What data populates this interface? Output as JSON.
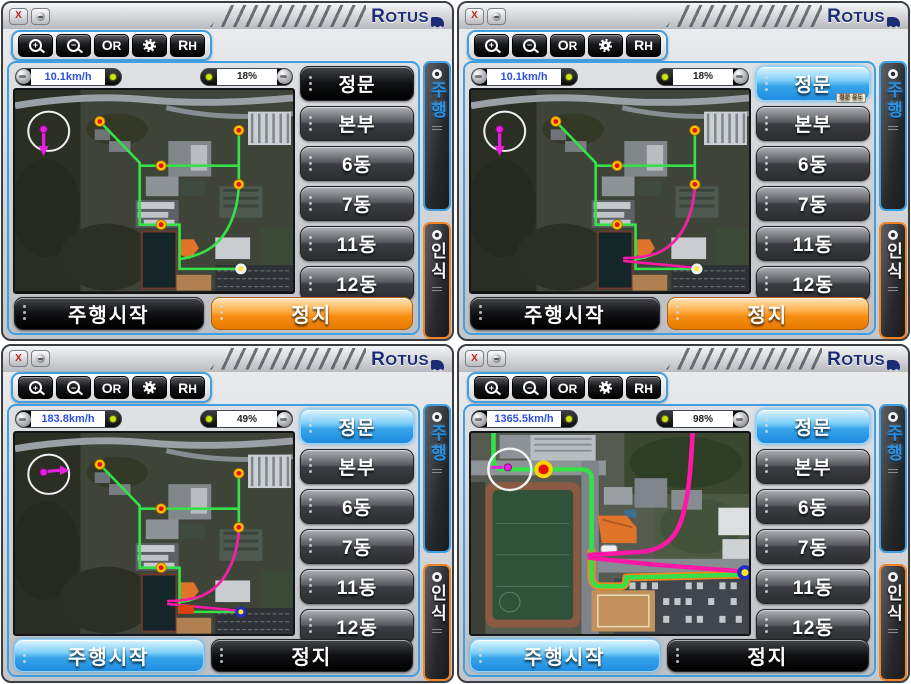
{
  "shared": {
    "logo_text": "ROTUS",
    "window": {
      "close_label": "X"
    },
    "toolbar": {
      "zoom_in": "zoom-in",
      "zoom_out": "zoom-out",
      "or_label": "OR",
      "gear": "settings",
      "rh_label": "RH"
    },
    "destinations": [
      "정문",
      "본부",
      "6동",
      "7동",
      "11동",
      "12동"
    ],
    "tabs": {
      "drive": "주행",
      "recognize": "인식"
    },
    "actions": {
      "start": "주행시작",
      "stop": "정지"
    },
    "active_badge": "정문 유도",
    "colors": {
      "accent_blue": "#3f9fe0",
      "accent_orange": "#ef8427",
      "route_green": "#35e048",
      "route_pink": "#ff18a8",
      "speed_text": "#2b50e0",
      "indicator_dot": "#c9e405"
    }
  },
  "panels": [
    {
      "speed": "10.1km/h",
      "progress": "18%",
      "dest_active_index": 0,
      "dest_active_style": "dark",
      "start_style": "dark",
      "stop_style": "orange",
      "map": "overview",
      "pink_route": false,
      "endpoint": "white",
      "robot_heading": "down",
      "badge": false,
      "highlight_rect": false
    },
    {
      "speed": "10.1km/h",
      "progress": "18%",
      "dest_active_index": 0,
      "dest_active_style": "blue",
      "start_style": "dark",
      "stop_style": "orange",
      "map": "overview",
      "pink_route": true,
      "endpoint": "white",
      "robot_heading": "down",
      "badge": true,
      "highlight_rect": false
    },
    {
      "speed": "183.8km/h",
      "progress": "49%",
      "dest_active_index": 0,
      "dest_active_style": "blue",
      "start_style": "blue",
      "stop_style": "dark",
      "map": "overview",
      "pink_route": true,
      "endpoint": "blue",
      "robot_heading": "right",
      "badge": false,
      "highlight_rect": true
    },
    {
      "speed": "1365.5km/h",
      "progress": "98%",
      "dest_active_index": 0,
      "dest_active_style": "blue",
      "start_style": "blue",
      "stop_style": "dark",
      "map": "zoomed",
      "pink_route": true,
      "endpoint": "blue",
      "robot_heading": "right",
      "badge": false,
      "highlight_rect": false
    }
  ]
}
